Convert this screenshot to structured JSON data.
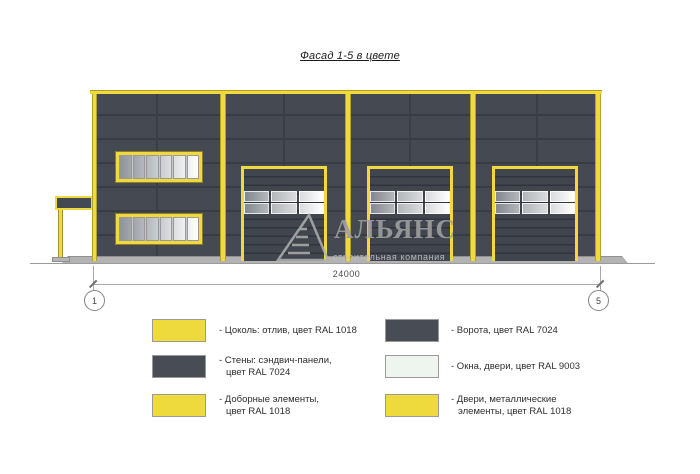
{
  "title": "Фасад 1-5 в цвете",
  "dimension": {
    "total": "24000",
    "axis_left": "1",
    "axis_right": "5"
  },
  "watermark": {
    "company": "АЛЬЯНС",
    "tagline": "строительная компания"
  },
  "legend": {
    "left": [
      {
        "swatch_color": "#efda3e",
        "lines": [
          "- Цоколь: отлив, цвет RAL 1018"
        ]
      },
      {
        "swatch_color": "#484c55",
        "lines": [
          "- Стены: сэндвич-панели,",
          "цвет RAL 7024"
        ]
      },
      {
        "swatch_color": "#efda3e",
        "lines": [
          "- Доборные элементы,",
          "цвет RAL 1018"
        ]
      }
    ],
    "right": [
      {
        "swatch_color": "#484c55",
        "lines": [
          "- Ворота, цвет RAL 7024"
        ]
      },
      {
        "swatch_color": "#eef5ef",
        "lines": [
          "- Окна, двери, цвет RAL 9003"
        ]
      },
      {
        "swatch_color": "#efda3e",
        "lines": [
          "- Двери, металлические",
          "элементы, цвет RAL 1018"
        ]
      }
    ]
  },
  "colors": {
    "accent_yellow": "#efd93e",
    "wall_dark": "#454952",
    "window_white": "#eef5ef"
  }
}
